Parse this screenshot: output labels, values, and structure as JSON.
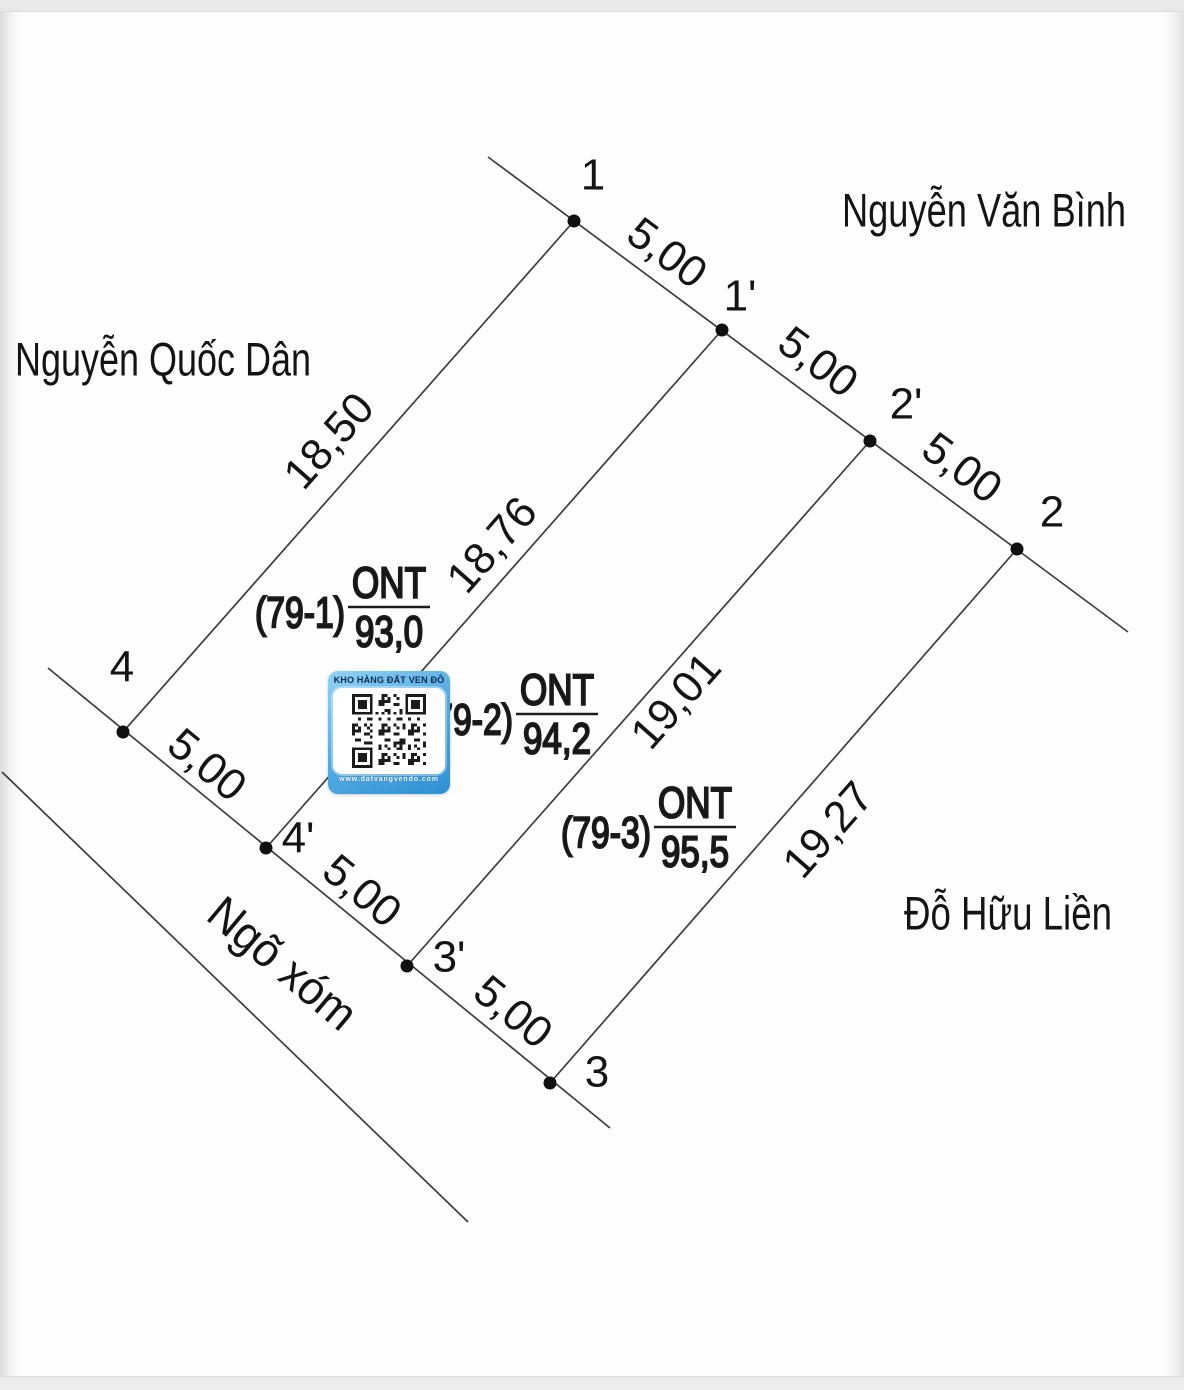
{
  "diagram": {
    "line_color": "#3d3d3d",
    "point_color": "#101010",
    "text_color": "#141414",
    "outline_fill": "#ffffff",
    "lines": [
      {
        "name": "street-edge-line",
        "x1": 488,
        "y1": 157,
        "x2": 1128,
        "y2": 632
      },
      {
        "name": "frontage-line",
        "x1": 48,
        "y1": 668,
        "x2": 610,
        "y2": 1128
      },
      {
        "name": "left-boundary-line",
        "x1": 574,
        "y1": 221,
        "x2": 123,
        "y2": 732
      },
      {
        "name": "plot-divider-line-1",
        "x1": 722,
        "y1": 330,
        "x2": 266,
        "y2": 848
      },
      {
        "name": "plot-divider-line-2",
        "x1": 870,
        "y1": 441,
        "x2": 407,
        "y2": 966
      },
      {
        "name": "right-boundary-line",
        "x1": 1017,
        "y1": 549,
        "x2": 550,
        "y2": 1083
      },
      {
        "name": "alley-edge-line",
        "x1": 2,
        "y1": 772,
        "x2": 468,
        "y2": 1222
      }
    ],
    "vertices": [
      {
        "label": "1",
        "x": 574,
        "y": 221,
        "lx": 593,
        "ly": 175
      },
      {
        "label": "1'",
        "x": 722,
        "y": 330,
        "lx": 740,
        "ly": 296
      },
      {
        "label": "2'",
        "x": 870,
        "y": 441,
        "lx": 906,
        "ly": 404
      },
      {
        "label": "2",
        "x": 1017,
        "y": 549,
        "lx": 1052,
        "ly": 512
      },
      {
        "label": "4",
        "x": 123,
        "y": 732,
        "lx": 122,
        "ly": 667
      },
      {
        "label": "4'",
        "x": 266,
        "y": 848,
        "lx": 298,
        "ly": 838
      },
      {
        "label": "3'",
        "x": 407,
        "y": 966,
        "lx": 449,
        "ly": 957
      },
      {
        "label": "3",
        "x": 550,
        "y": 1083,
        "lx": 597,
        "ly": 1072
      }
    ],
    "dimensions": [
      {
        "text": "5,00",
        "x": 667,
        "y": 253,
        "rot": 36.6
      },
      {
        "text": "5,00",
        "x": 818,
        "y": 362,
        "rot": 36.6
      },
      {
        "text": "5,00",
        "x": 962,
        "y": 468,
        "rot": 36.6
      },
      {
        "text": "5,00",
        "x": 207,
        "y": 765,
        "rot": 39.4
      },
      {
        "text": "5,00",
        "x": 362,
        "y": 891,
        "rot": 39.4
      },
      {
        "text": "5,00",
        "x": 513,
        "y": 1012,
        "rot": 39.4
      },
      {
        "text": "18,50",
        "x": 329,
        "y": 441,
        "rot": -48.6
      },
      {
        "text": "18,76",
        "x": 492,
        "y": 545,
        "rot": -48.6
      },
      {
        "text": "19,01",
        "x": 676,
        "y": 701,
        "rot": -48.6
      },
      {
        "text": "19,27",
        "x": 828,
        "y": 830,
        "rot": -48.6
      }
    ],
    "street_labels": [
      {
        "text": "Nguyễn Văn Bình",
        "x": 984,
        "y": 210,
        "rot": 0,
        "len": 284
      },
      {
        "text": "Nguyễn Quốc Dân",
        "x": 163,
        "y": 359,
        "rot": 0,
        "len": 296
      },
      {
        "text": "Đỗ Hữu Liền",
        "x": 1008,
        "y": 913,
        "rot": 0,
        "len": 208
      },
      {
        "text": "Ngõ xóm",
        "x": 283,
        "y": 963,
        "rot": 40,
        "len": 178
      }
    ],
    "plots": [
      {
        "parcel": "(79-1)",
        "land_use": "ONT",
        "area": "93,0",
        "cx": 389,
        "cy": 607
      },
      {
        "parcel": "(79-2)",
        "land_use": "ONT",
        "area": "94,2",
        "cx": 557,
        "cy": 714
      },
      {
        "parcel": "(79-3)",
        "land_use": "ONT",
        "area": "95,5",
        "cx": 695,
        "cy": 827
      }
    ]
  },
  "qr_badge": {
    "title": "KHO HÀNG ĐẤT VEN ĐÔ",
    "url": "www.datvangvendo.com",
    "gradient_start": "#93d4f4",
    "gradient_end": "#2e91d2",
    "title_color": "#0e2c55",
    "url_color": "#f8f9ff"
  }
}
